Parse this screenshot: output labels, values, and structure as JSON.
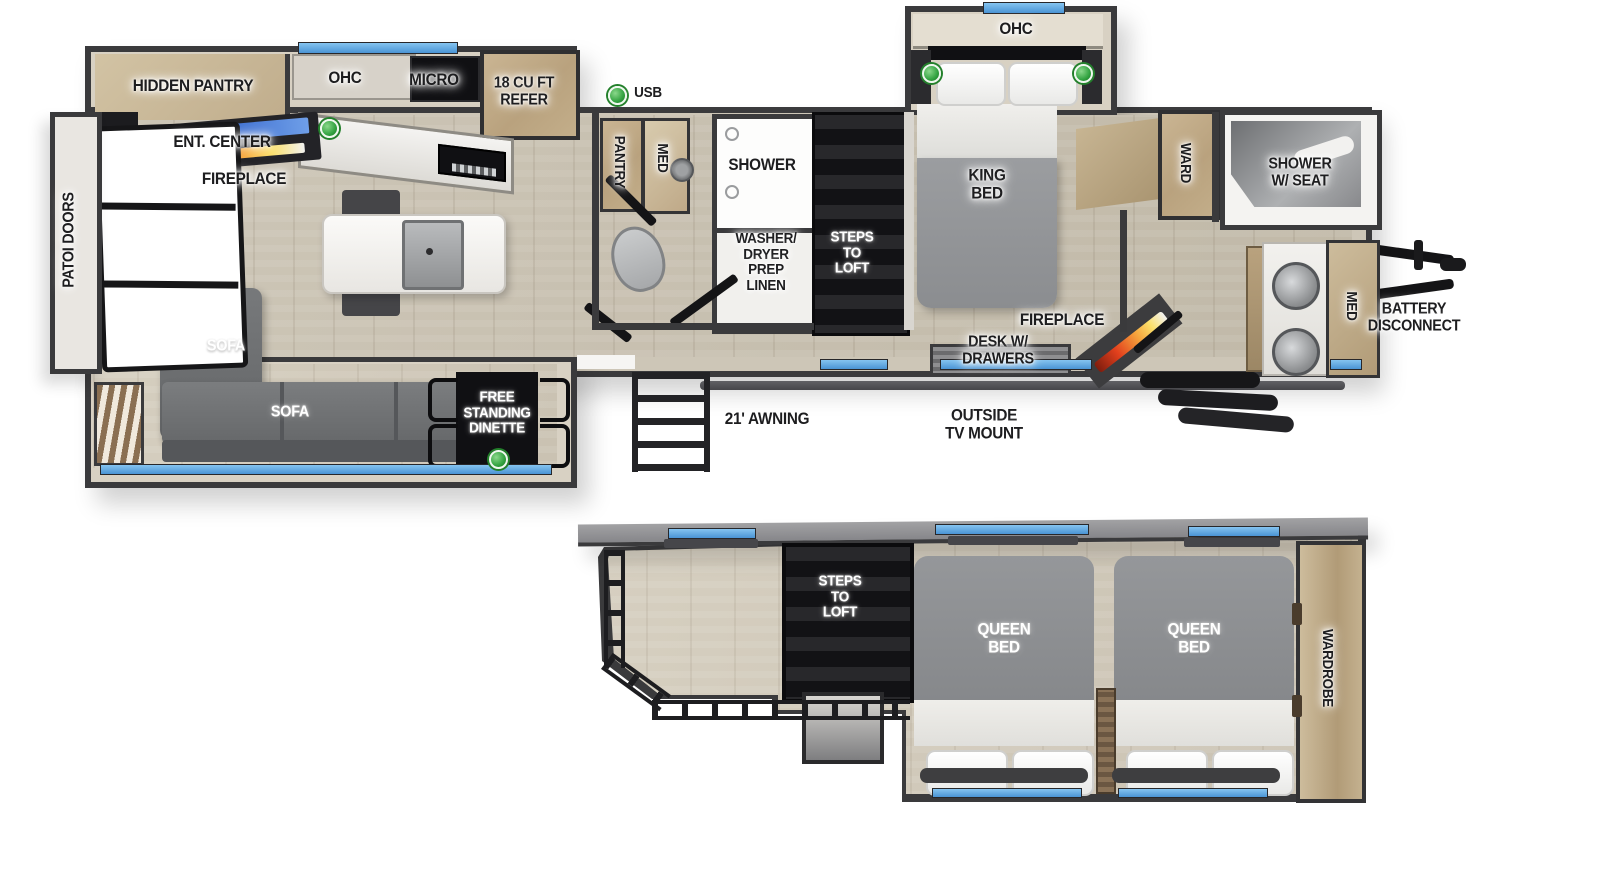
{
  "plan": {
    "kind": "travel-trailer-floorplan",
    "views": [
      "main floor",
      "loft"
    ]
  },
  "labels": {
    "patio_doors": "PATOI DOORS",
    "hidden_pantry": "HIDDEN PANTRY",
    "ent_center": "ENT. CENTER",
    "fireplace_living": "FIREPLACE",
    "ohc_kitchen": "OHC",
    "micro": "MICRO",
    "refer": "18 CU FT\nREFER",
    "usb": "USB",
    "pantry": "PANTRY",
    "med_bath": "MED",
    "shower": "SHOWER",
    "washer_dryer": "WASHER/\nDRYER\nPREP\nLINEN",
    "steps_to_loft_main": "STEPS\nTO\nLOFT",
    "king_bed": "KING\nBED",
    "ohc_bedroom": "OHC",
    "ward": "WARD",
    "shower_w_seat": "SHOWER\nW/ SEAT",
    "fireplace_bedroom": "FIREPLACE",
    "desk_w_drawers": "DESK W/\nDRAWERS",
    "med_front": "MED",
    "battery_disconnect": "BATTERY\nDISCONNECT",
    "sofa_chaise": "SOFA",
    "sofa_main": "SOFA",
    "free_standing_dinette": "FREE\nSTANDING\nDINETTE",
    "awning": "21' AWNING",
    "outside_tv_mount": "OUTSIDE\nTV MOUNT",
    "steps_to_loft_loft": "STEPS\nTO\nLOFT",
    "queen_bed_left": "QUEEN\nBED",
    "queen_bed_right": "QUEEN\nBED",
    "wardrobe": "WARDROBE"
  },
  "colors": {
    "wall": "#3a3a3c",
    "window_blue": "#5aa3dd",
    "usb_green": "#33a341",
    "floor_wood": "#c7bfae",
    "cabinet_wood": "#bfa887",
    "furniture_gray": "#6d6f71",
    "fireplace_orange": "#e2401d",
    "ent_screen_blue": "#2b5cc8"
  }
}
